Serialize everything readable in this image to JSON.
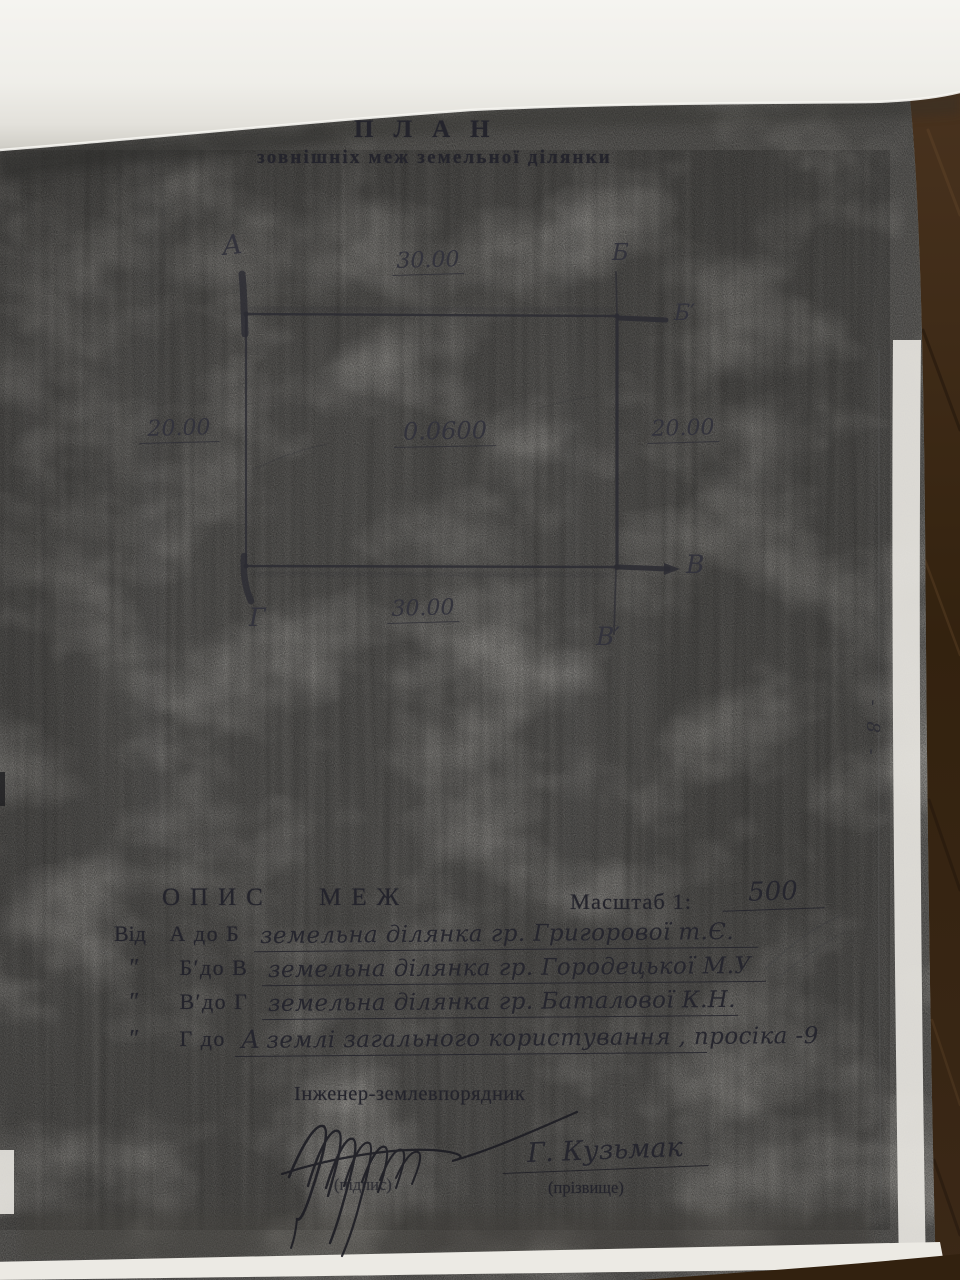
{
  "document": {
    "title": "ПЛАН",
    "subtitle": "зовнішніх меж земельної ділянки",
    "page_number": "- 8 -"
  },
  "plan": {
    "corner_labels": {
      "a": "А",
      "b": "Б",
      "b_prime": "Б′",
      "v": "В",
      "v_prime": "В′",
      "g": "Г"
    },
    "dimensions": {
      "top": "30.00",
      "bottom": "30.00",
      "left": "20.00",
      "right": "20.00"
    },
    "area": "0.0600"
  },
  "legend": {
    "heading": "ОПИС МЕЖ",
    "scale_label": "Масштаб 1:",
    "scale_value": "500",
    "rows": [
      {
        "prefix": "Від",
        "range": "А до Б",
        "value": "земельна ділянка  гр. Григорової  т.Є."
      },
      {
        "prefix": "″",
        "range": "Б′до В",
        "value": "земельна ділянка  гр. Городецької  М.У"
      },
      {
        "prefix": "″",
        "range": "В′до Г",
        "value": "земельна ділянка  гр. Баталової  К.Н."
      },
      {
        "prefix": "″",
        "range": "Г до",
        "value_initial": "А",
        "value": "землі загального користування , просіка -9"
      }
    ]
  },
  "signature": {
    "role": "Інженер-землевпорядник",
    "signature_caption": "(підпис)",
    "name": "Г. Кузьмак",
    "name_caption": "(прізвище)"
  },
  "colors": {
    "paper": "#d4d1cb",
    "overlay_page": "#f2f1ec",
    "wood": "#3a2817",
    "ink": "#24242c",
    "pencil": "#33333c"
  }
}
